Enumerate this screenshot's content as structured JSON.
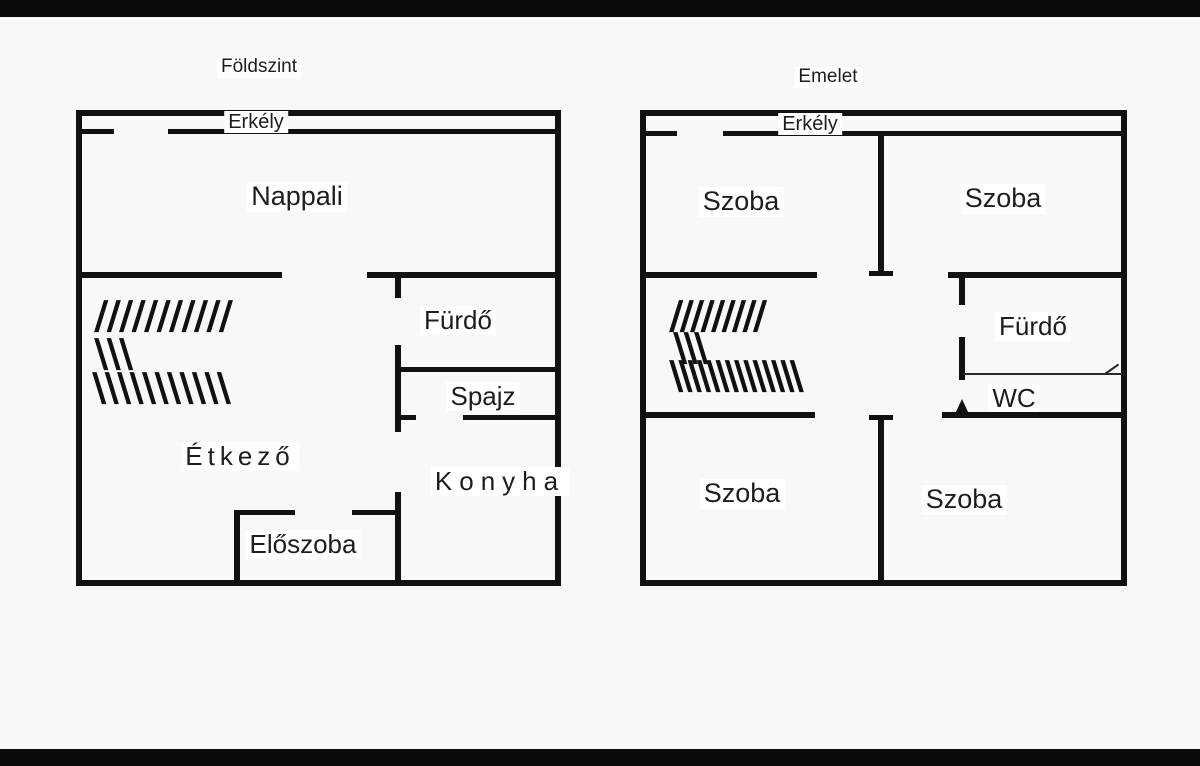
{
  "page": {
    "background": "#f8f8f8",
    "bar_color": "#0a0a0a",
    "wall_color": "#111111",
    "text_color": "#1d1d1d"
  },
  "plans": [
    {
      "title": "Földszint",
      "rooms": {
        "erkely": "Erkély",
        "nappali": "Nappali",
        "furdo": "Fürdő",
        "spajz": "Spajz",
        "etkezo": "Étkező",
        "konyha": "Konyha",
        "eloszoba": "Előszoba"
      },
      "stairs_hatch": {
        "row1": "///////////",
        "row2": "\\\\\\",
        "row3": "\\\\\\\\\\\\\\\\\\\\\\"
      }
    },
    {
      "title": "Emelet",
      "rooms": {
        "erkely": "Erkély",
        "szoba_top_left": "Szoba",
        "szoba_top_right": "Szoba",
        "furdo": "Fürdő",
        "wc": "WC",
        "szoba_bottom_left": "Szoba",
        "szoba_bottom_right": "Szoba"
      },
      "stairs_hatch": {
        "row1": "/////////",
        "row2": "\\\\\\",
        "row3": "\\\\\\\\\\\\\\\\\\\\\\\\\\\\"
      }
    }
  ]
}
